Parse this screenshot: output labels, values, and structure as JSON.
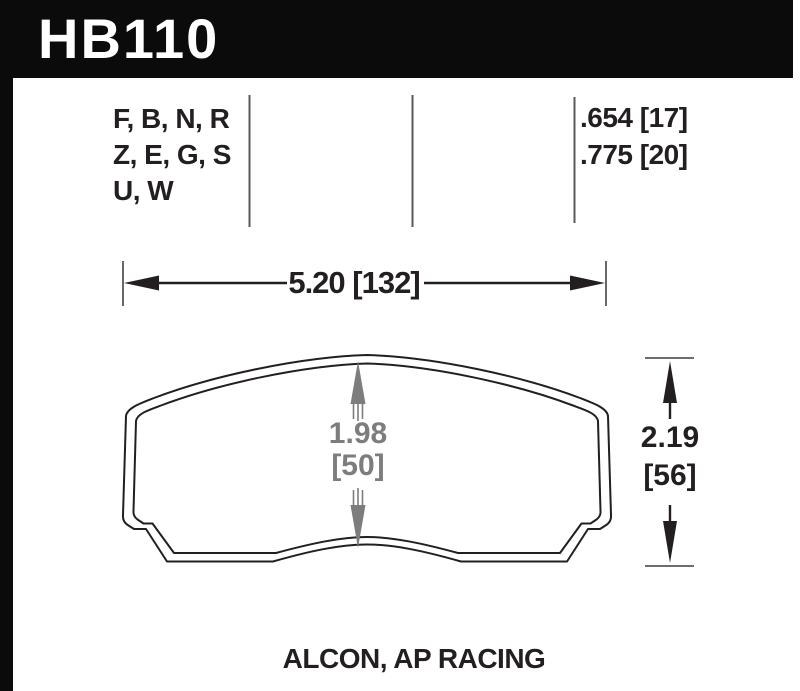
{
  "part": {
    "number": "HB110"
  },
  "spec_table": {
    "compound_lines": [
      "F, B, N, R",
      "Z, E, G, S",
      "U, W"
    ],
    "thickness_lines": [
      ".654 [17]",
      ".775 [20]"
    ]
  },
  "dimensions": {
    "overall_width": "5.20 [132]",
    "overall_height": {
      "inches": "2.19",
      "mm": "[56]"
    },
    "pad_center_height": {
      "inches": "1.98",
      "mm": "[50]"
    }
  },
  "footer": {
    "applications": "ALCON, AP RACING"
  },
  "colors": {
    "bar": "#0b0b0b",
    "ink": "#231f20",
    "dim": "#7d7d7d",
    "line": "#57585a",
    "paper": "#ffffff"
  }
}
